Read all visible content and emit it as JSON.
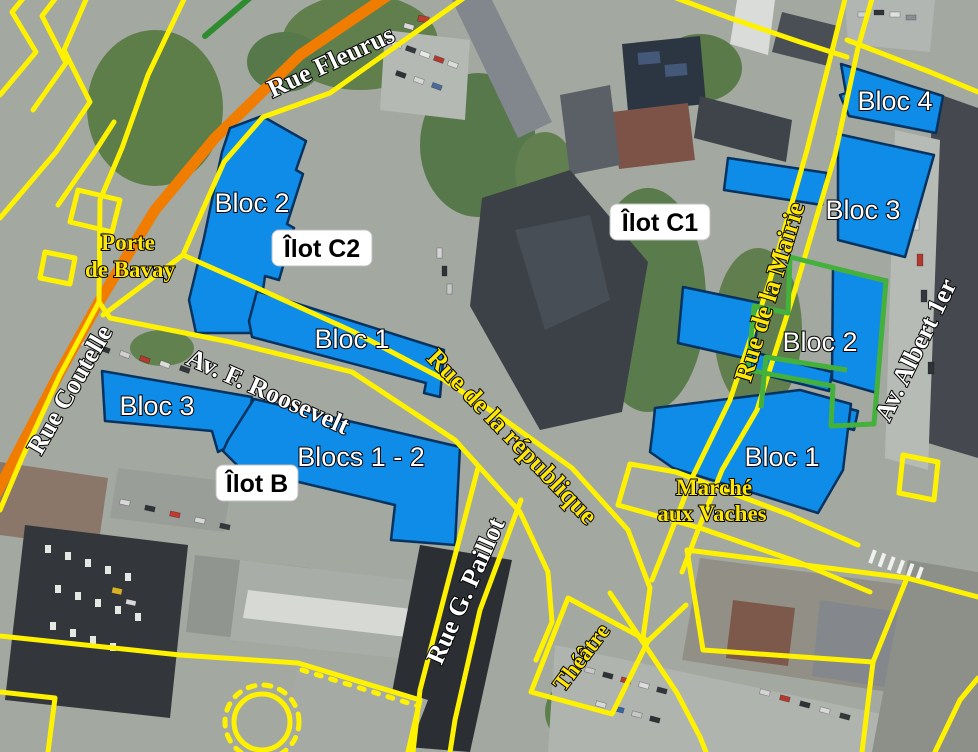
{
  "map": {
    "ilots": [
      {
        "id": "C2",
        "label": "Îlot C2"
      },
      {
        "id": "C1",
        "label": "Îlot C1"
      },
      {
        "id": "B",
        "label": "Îlot B"
      }
    ],
    "blocks": [
      {
        "ilot": "C2",
        "label": "Bloc 2"
      },
      {
        "ilot": "C2",
        "label": "Bloc 1"
      },
      {
        "ilot": "B",
        "label": "Bloc 3"
      },
      {
        "ilot": "B",
        "label": "Blocs 1 - 2"
      },
      {
        "ilot": "C1",
        "label": "Bloc 4"
      },
      {
        "ilot": "C1",
        "label": "Bloc 3"
      },
      {
        "ilot": "C1",
        "label": "Bloc 2"
      },
      {
        "ilot": "C1",
        "label": "Bloc 1"
      }
    ],
    "streets": [
      {
        "name": "Rue Fleurus",
        "color": "#FFFFFF"
      },
      {
        "name": "Rue Coutelle",
        "color": "#FFFFFF"
      },
      {
        "name": "Av. F. Roosevelt",
        "color": "#FFFFFF"
      },
      {
        "name": "Rue de la république",
        "color": "#FFE60A"
      },
      {
        "name": "Rue G. Paillot",
        "color": "#FFFFFF"
      },
      {
        "name": "Rue de la Mairie",
        "color": "#FFE60A"
      },
      {
        "name": "Av. Albert 1er",
        "color": "#FFFFFF"
      }
    ],
    "places": [
      {
        "name": "Porte de Bavay",
        "lines": [
          "Porte",
          "de Bavay"
        ],
        "color": "#FFE60A"
      },
      {
        "name": "Marché aux Vaches",
        "lines": [
          "Marché",
          "aux Vaches"
        ],
        "color": "#FFE60A"
      },
      {
        "name": "Théâtre",
        "lines": [
          "Théâtre"
        ],
        "color": "#FFE60A"
      }
    ]
  },
  "colors": {
    "block_fill": "#0E8CE8",
    "block_stroke": "#05325F",
    "road_yellow": "#FFF200",
    "road_orange": "#F07D00",
    "overlay_green": "#43B13C",
    "street_label_white": "#FFFFFF",
    "street_label_yellow": "#FFE60A"
  }
}
